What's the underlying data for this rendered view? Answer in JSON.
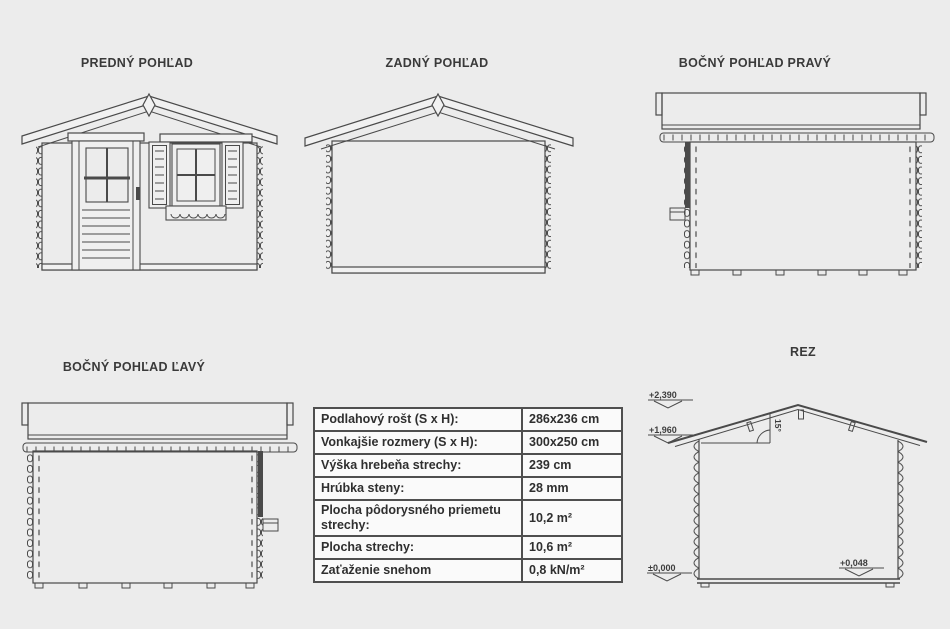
{
  "views": {
    "front": {
      "title": "PREDNÝ POHĽAD"
    },
    "rear": {
      "title": "ZADNÝ POHĽAD"
    },
    "right": {
      "title": "BOČNÝ POHĽAD PRAVÝ"
    },
    "left": {
      "title": "BOČNÝ POHĽAD ĽAVÝ"
    },
    "section": {
      "title": "REZ",
      "levels": {
        "ridge": "+2,390",
        "eaves": "+1,960",
        "ground": "±0,000",
        "floor": "+0,048"
      },
      "roof_angle": "15°"
    }
  },
  "spec_table": {
    "rows": [
      {
        "label": "Podlahový rošt (S x H):",
        "value": "286x236 cm"
      },
      {
        "label": "Vonkajšie rozmery (S x H):",
        "value": "300x250 cm"
      },
      {
        "label": "Výška hrebeňa strechy:",
        "value": "239 cm"
      },
      {
        "label": "Hrúbka steny:",
        "value": "28 mm"
      },
      {
        "label": "Plocha pôdorysného priemetu strechy:",
        "value": "10,2 m²"
      },
      {
        "label": "Plocha strechy:",
        "value": "10,6 m²"
      },
      {
        "label": "Zaťaženie snehom",
        "value": "0,8 kN/m²"
      }
    ]
  },
  "colors": {
    "background": "#ececec",
    "line": "#4a4a4a",
    "table_border": "#4f4f4f"
  }
}
